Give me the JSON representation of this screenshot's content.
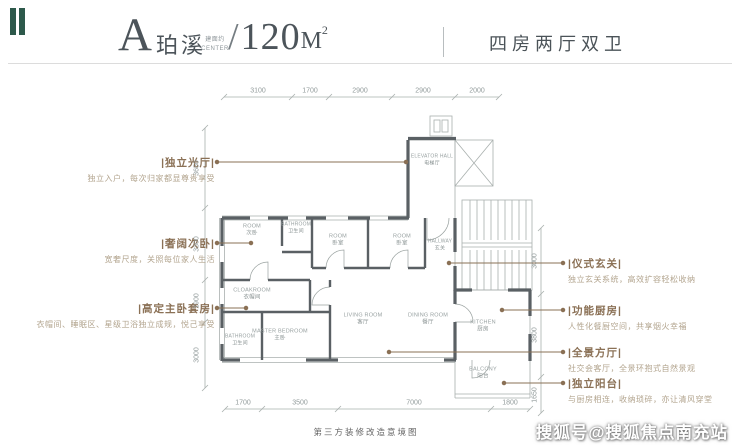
{
  "header": {
    "unit_letter": "A",
    "unit_name": "珀溪",
    "area_prefix_line1": "建面约",
    "area_prefix_line2": "CENTER",
    "slash": "/",
    "area_value": "120",
    "area_unit": "M",
    "area_sup": "2",
    "layout_label": "四房两厅双卫"
  },
  "features_left": [
    {
      "title": "|独立光厅|",
      "desc": "独立入户，每次归家都显尊贵享受"
    },
    {
      "title": "|奢阔次卧|",
      "desc": "宽奢尺度，关照每位家人生活"
    },
    {
      "title": "|高定主卧套房|",
      "desc": "衣帽间、睡眠区、星级卫浴独立成规，悦己享受"
    }
  ],
  "features_right": [
    {
      "title": "|仪式玄关|",
      "desc": "独立玄关系统，高效扩容轻松收纳"
    },
    {
      "title": "|功能厨房|",
      "desc": "人性化餐厨空间，共享烟火幸福"
    },
    {
      "title": "|全景方厅|",
      "desc": "社交会客厅，全景环抱式自然景观"
    },
    {
      "title": "|独立阳台|",
      "desc": "与厨房相连，收纳琐碎，亦让清风穿堂"
    }
  ],
  "dimensions": {
    "top": [
      "3100",
      "1700",
      "2900",
      "2900",
      "2000"
    ],
    "bottom": [
      "1700",
      "3500",
      "7000",
      "1800"
    ],
    "left": [
      "3650",
      "3300",
      "1900",
      "3000"
    ],
    "right": [
      "3000",
      "3800",
      "1650"
    ]
  },
  "rooms": [
    {
      "en": "ELEVATOR HALL",
      "zh": "电梯厅"
    },
    {
      "en": "ROOM",
      "zh": "次卧"
    },
    {
      "en": "BATHROOM",
      "zh": "卫生间"
    },
    {
      "en": "ROOM",
      "zh": "卧室"
    },
    {
      "en": "ROOM",
      "zh": "卧室"
    },
    {
      "en": "HALLWAY",
      "zh": "玄关"
    },
    {
      "en": "CLOAKROOM",
      "zh": "衣帽间"
    },
    {
      "en": "BATHROOM",
      "zh": "卫生间"
    },
    {
      "en": "MASTER BEDROOM",
      "zh": "主卧"
    },
    {
      "en": "LIVING ROOM",
      "zh": "客厅"
    },
    {
      "en": "DINING ROOM",
      "zh": "餐厅"
    },
    {
      "en": "KITCHEN",
      "zh": "厨房"
    },
    {
      "en": "BALCONY",
      "zh": "阳台"
    }
  ],
  "footer": {
    "caption": "第三方装修改造意境图",
    "watermark": "搜狐号@搜狐焦点南充站"
  },
  "colors": {
    "accent_teal": "#2d594b",
    "feature_title": "#8b7156",
    "feature_desc": "#b3a58f",
    "wall": "#5a6064",
    "thin_line": "#a9b0ae",
    "dim_text": "#929b9b"
  }
}
